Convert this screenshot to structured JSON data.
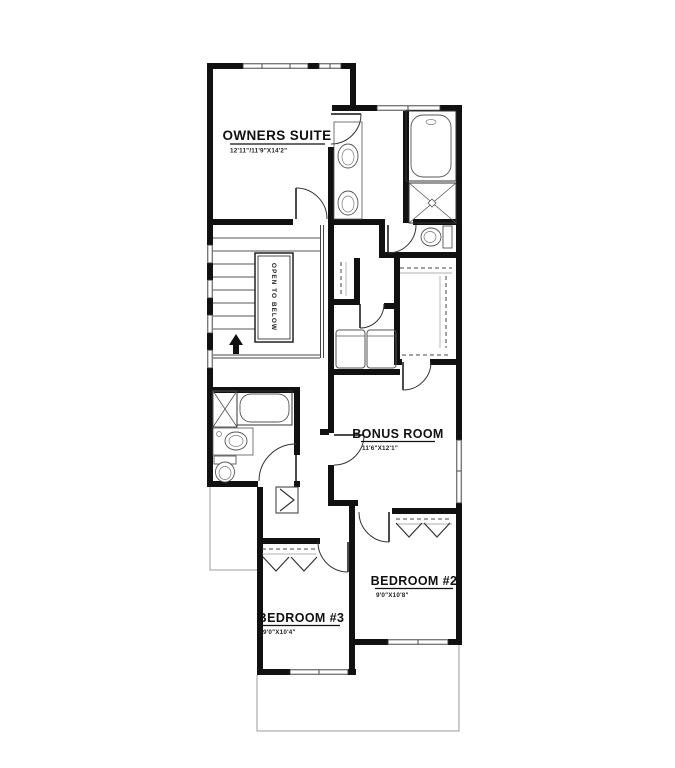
{
  "plan": {
    "type": "floor-plan-upper-level",
    "rooms": [
      {
        "name": "OWNERS SUITE",
        "dims": "12'11\"/11'9\"X14'2\""
      },
      {
        "name": "BONUS ROOM",
        "dims": "11'6\"X12'1\""
      },
      {
        "name": "BEDROOM #2",
        "dims": "9'0\"X10'8\""
      },
      {
        "name": "BEDROOM #3",
        "dims": "9'0\"X10'4\""
      }
    ],
    "stairs": {
      "label": "OPEN TO BELOW",
      "direction": "up-arrow"
    },
    "colors": {
      "wall": "#111111",
      "line": "#333333",
      "fixture": "#555555",
      "below_outline": "#9b9b9b",
      "background": "#ffffff"
    },
    "fixtures": [
      "bathtub-icon",
      "shower-icon",
      "toilet-icon",
      "sink-icon",
      "double-vanity",
      "washer-icon",
      "dryer-icon",
      "linen-shelf-icon",
      "closet-rod",
      "bifold-door",
      "door-arc",
      "window",
      "up-arrow-icon"
    ]
  }
}
